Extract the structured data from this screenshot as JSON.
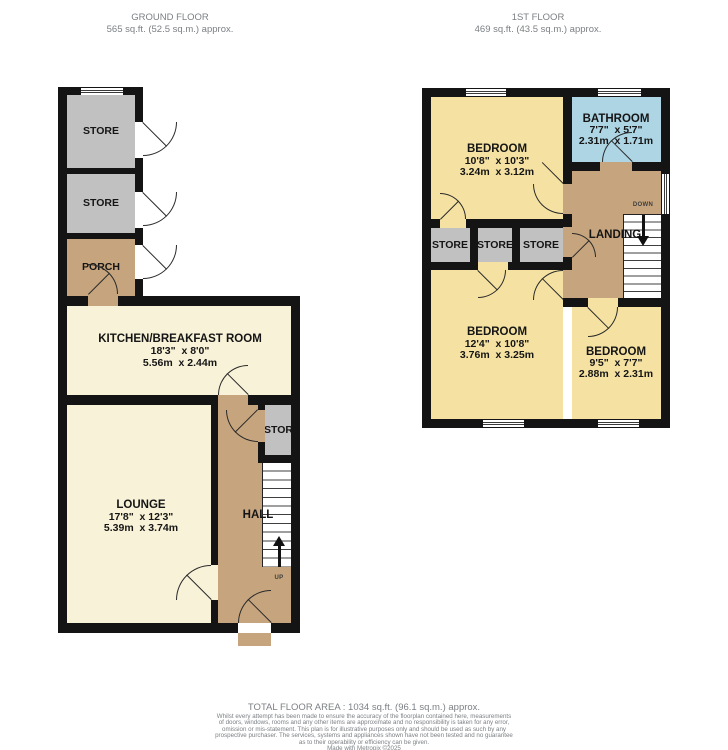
{
  "floors": {
    "ground": {
      "title": "GROUND FLOOR",
      "area": "565 sq.ft. (52.5 sq.m.) approx.",
      "rooms": {
        "store_top_1": "STORE",
        "store_top_2": "STORE",
        "porch": "PORCH",
        "kitchen_name": "KITCHEN/BREAKFAST ROOM",
        "kitchen_imperial": "18'3\"  x 8'0\"",
        "kitchen_metric": "5.56m  x 2.44m",
        "lounge_name": "LOUNGE",
        "lounge_imperial": "17'8\"  x 12'3\"",
        "lounge_metric": "5.39m  x 3.74m",
        "hall": "HALL",
        "hall_store": "STORE",
        "stairs_label": "UP"
      }
    },
    "first": {
      "title": "1ST FLOOR",
      "area": "469 sq.ft. (43.5 sq.m.) approx.",
      "rooms": {
        "bedroom1_name": "BEDROOM",
        "bedroom1_imperial": "10'8\"  x 10'3\"",
        "bedroom1_metric": "3.24m  x 3.12m",
        "bathroom_name": "BATHROOM",
        "bathroom_imperial": "7'7\"  x 5'7\"",
        "bathroom_metric": "2.31m  x 1.71m",
        "store_1": "STORE",
        "store_2": "STORE",
        "store_3": "STORE",
        "landing": "LANDING",
        "stairs_label": "DOWN",
        "bedroom2_name": "BEDROOM",
        "bedroom2_imperial": "12'4\"  x 10'8\"",
        "bedroom2_metric": "3.76m  x 3.25m",
        "bedroom3_name": "BEDROOM",
        "bedroom3_imperial": "9'5\"  x 7'7\"",
        "bedroom3_metric": "2.88m  x 2.31m"
      }
    }
  },
  "footer": {
    "total_area": "TOTAL FLOOR AREA : 1034 sq.ft. (96.1 sq.m.) approx.",
    "disclaimer": [
      "Whilst every attempt has been made to ensure the accuracy of the floorplan contained here, measurements",
      "of doors, windows, rooms and any other items are approximate and no responsibility is taken for any error,",
      "omission or mis-statement. This plan is for illustrative purposes only and should be used as such by any",
      "prospective purchaser. The services, systems and appliances shown have not been tested and no guarantee",
      "as to their operability or efficiency can be given.",
      "Made with Metropix ©2025"
    ]
  },
  "colors": {
    "wall": "#141414",
    "cream": "#f8f2d8",
    "yellow": "#f5e2a2",
    "tan": "#c6a57e",
    "gray": "#c2c1c1",
    "blue": "#aed5e4",
    "muted": "#7c8084",
    "label": "#151515"
  }
}
